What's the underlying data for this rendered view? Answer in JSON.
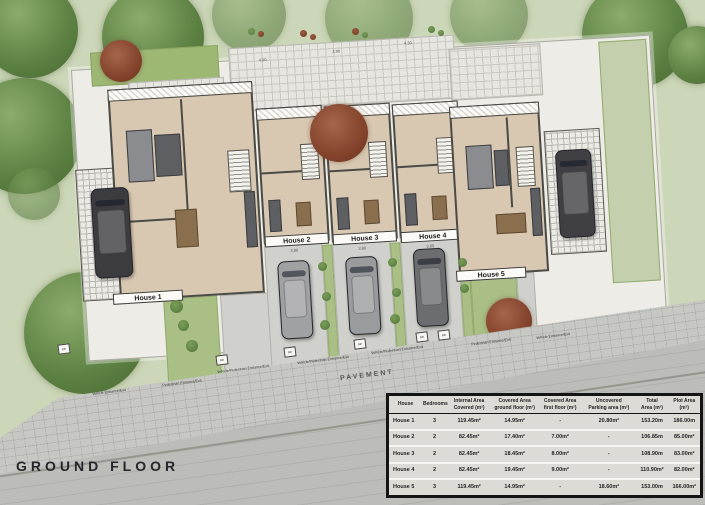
{
  "title": "GROUND FLOOR",
  "labels": {
    "pavement": "PAVEMENT",
    "bin": "Bin"
  },
  "houses": [
    {
      "label": "House 1"
    },
    {
      "label": "House 2"
    },
    {
      "label": "House 3"
    },
    {
      "label": "House 4"
    },
    {
      "label": "House 5"
    }
  ],
  "entrances": [
    "Vehicle Entrance/Exit",
    "Pedestrian Entrance/Exit",
    "Vehicle/Pedestrian Entrance/Exit",
    "Vehicle/Pedestrian Entrance/Exit",
    "Vehicle/Pedestrian Entrance/Exit",
    "Pedestrian Entrance/Exit",
    "Vehicle Entrance/Exit"
  ],
  "dimensions": [
    "4.00",
    "3.90",
    "4.30",
    "3.85",
    "5.00",
    "3.80",
    "3.80",
    "3.80",
    "2.80"
  ],
  "table": {
    "headers": [
      "House",
      "Bedrooms",
      "Internal Area\nCovered (m²)",
      "Covered Area\nground floor (m²)",
      "Covered Area\nfirst floor (m²)",
      "Uncovered\nParking area (m²)",
      "Total\nArea (m²)",
      "Plot Area\n(m²)"
    ],
    "rows": [
      [
        "House 1",
        "3",
        "119.45m²",
        "14.95m²",
        "-",
        "20.80m²",
        "153.20m",
        "186.00m"
      ],
      [
        "House 2",
        "2",
        "82.45m²",
        "17.40m²",
        "7.00m²",
        "-",
        "106.85m",
        "85.00m²"
      ],
      [
        "House 3",
        "2",
        "82.45m²",
        "18.45m²",
        "8.00m²",
        "-",
        "108.90m",
        "83.00m²"
      ],
      [
        "House 4",
        "2",
        "82.45m²",
        "19.45m²",
        "9.00m²",
        "-",
        "110.90m²",
        "82.00m²"
      ],
      [
        "House 5",
        "3",
        "119.45m²",
        "14.95m²",
        "-",
        "18.60m²",
        "153.00m",
        "166.00m²"
      ]
    ]
  },
  "colors": {
    "grass": "#ccd6b8",
    "site": "#edece6",
    "floor": "#d8c8b1",
    "pavement": "#c7c7c3",
    "road": "#bcbcb8",
    "tree_green": "#5f8445",
    "tree_red": "#84432c",
    "table_border": "#141414"
  }
}
